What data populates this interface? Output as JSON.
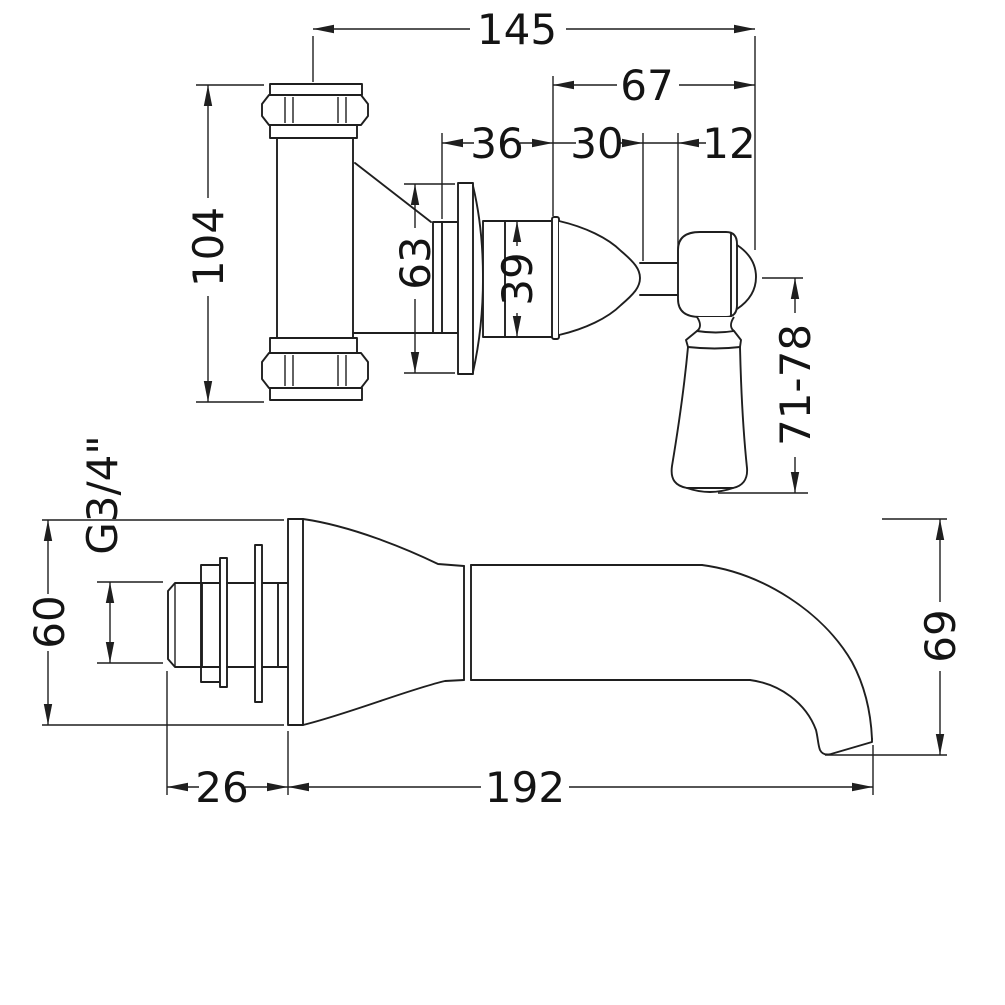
{
  "drawing": {
    "title": "Wall mounted tap - technical dimension drawing",
    "background": "#ffffff",
    "line_color": "#1f1f1f",
    "units": "mm",
    "views": {
      "valve": {
        "name": "concealed valve and lever handle elevation",
        "labels": {
          "overall_width": "145",
          "handle_projection": "67",
          "body_to_flange": "36",
          "flange_to_stem": "30",
          "stem_width": "12",
          "body_height": "104",
          "backplate_height": "63",
          "cartridge_height": "39",
          "handle_drop_range": "71-78"
        }
      },
      "spout": {
        "name": "wall spout elevation",
        "labels": {
          "thread_size": "G3/4\"",
          "backplate_height": "60",
          "thread_length": "26",
          "spout_reach": "192",
          "spout_drop": "69"
        }
      }
    }
  }
}
